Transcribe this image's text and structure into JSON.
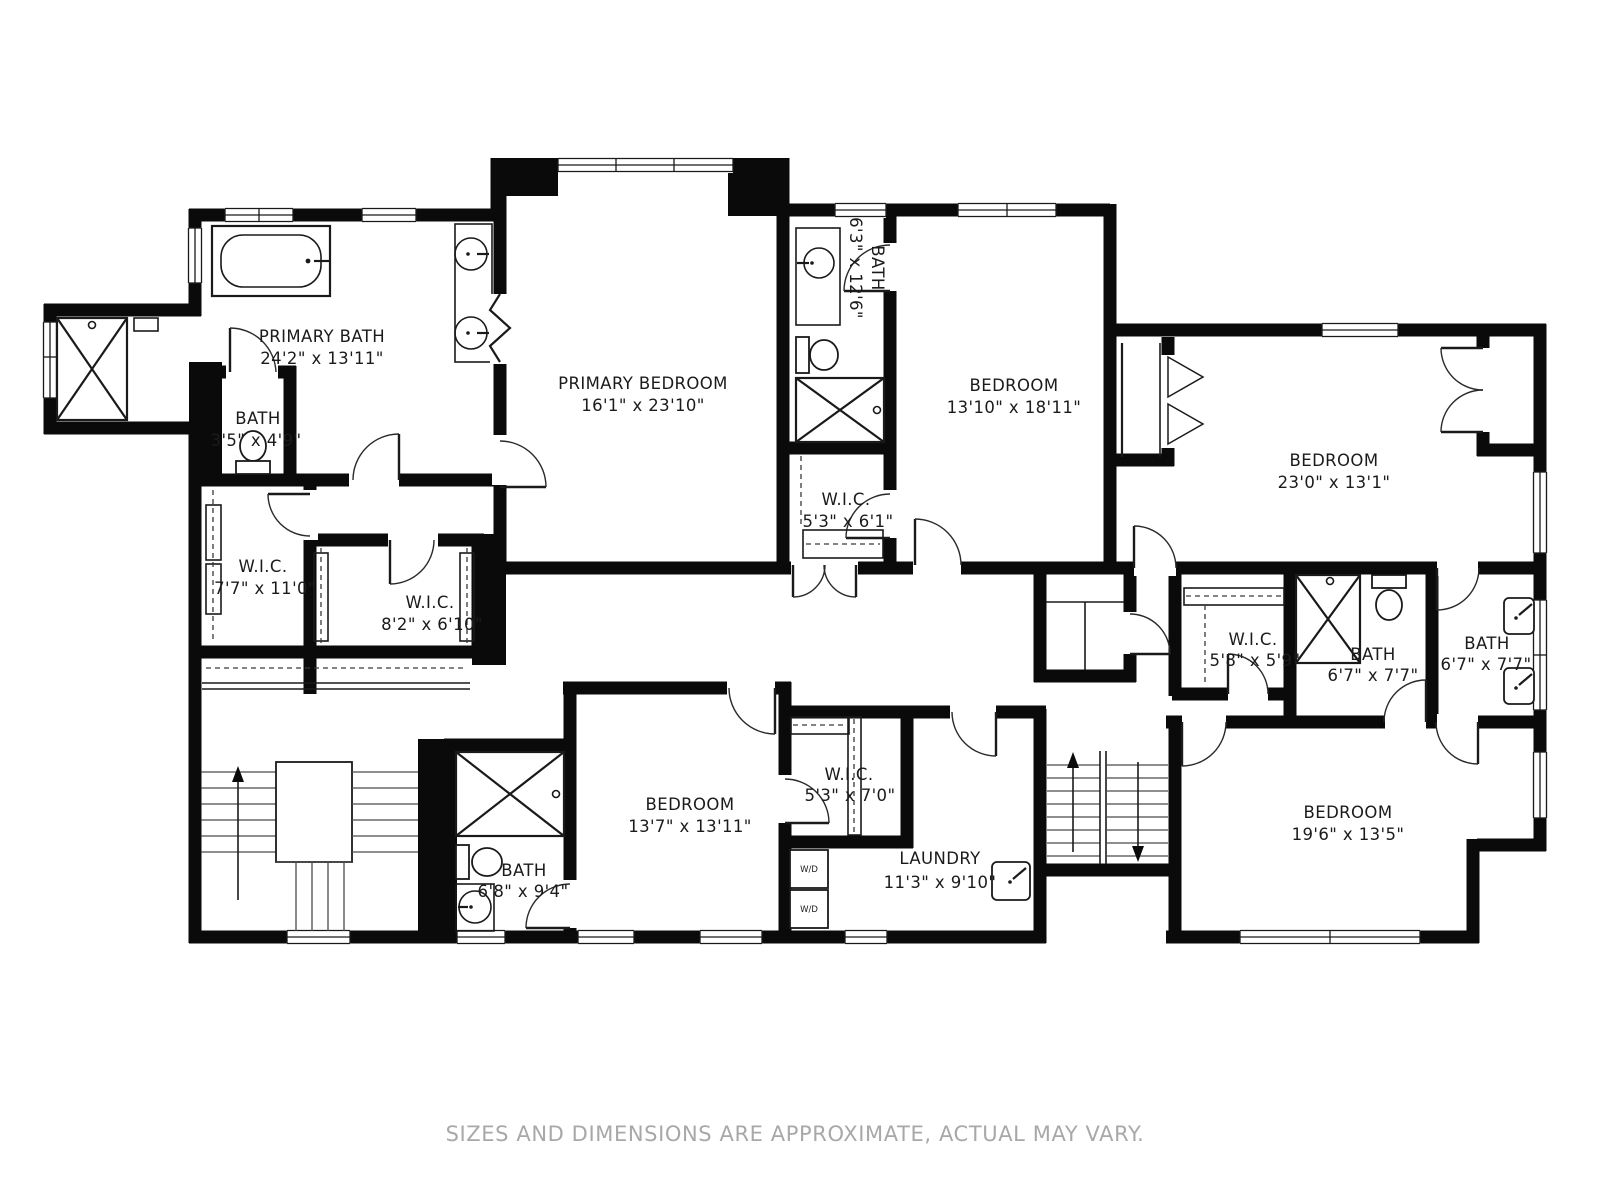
{
  "floorplan": {
    "rooms": [
      {
        "id": "primary-bath",
        "name": "PRIMARY BATH",
        "dims": "24'2\" x 13'11\""
      },
      {
        "id": "bath-small",
        "name": "BATH",
        "dims": "3'5\" x 4'9\""
      },
      {
        "id": "primary-bedroom",
        "name": "PRIMARY BEDROOM",
        "dims": "16'1\" x 23'10\""
      },
      {
        "id": "bath-ensuite",
        "name": "BATH",
        "dims": "6'3\" x 12'6\""
      },
      {
        "id": "bedroom-top",
        "name": "BEDROOM",
        "dims": "13'10\" x 18'11\""
      },
      {
        "id": "bedroom-right",
        "name": "BEDROOM",
        "dims": "23'0\" x 13'1\""
      },
      {
        "id": "wic-small",
        "name": "W.I.C.",
        "dims": "5'3\" x 6'1\""
      },
      {
        "id": "wic-left",
        "name": "W.I.C.",
        "dims": "7'7\" x 11'0\""
      },
      {
        "id": "wic-mid",
        "name": "W.I.C.",
        "dims": "8'2\" x 6'10\""
      },
      {
        "id": "wic-right",
        "name": "W.I.C.",
        "dims": "5'8\" x 5'9\""
      },
      {
        "id": "bath-shared-left",
        "name": "BATH",
        "dims": "6'7\" x 7'7\""
      },
      {
        "id": "bath-shared-right",
        "name": "BATH",
        "dims": "6'7\" x 7'7\""
      },
      {
        "id": "bedroom-bottom",
        "name": "BEDROOM",
        "dims": "13'7\" x 13'11\""
      },
      {
        "id": "wic-bottom",
        "name": "W.I.C.",
        "dims": "5'3\" x 7'0\""
      },
      {
        "id": "laundry",
        "name": "LAUNDRY",
        "dims": "11'3\" x 9'10\""
      },
      {
        "id": "bath-bottom",
        "name": "BATH",
        "dims": "6'8\" x 9'4\""
      },
      {
        "id": "bedroom-bottom-right",
        "name": "BEDROOM",
        "dims": "19'6\" x 13'5\""
      }
    ],
    "appliances": {
      "washer_dryer_top": "W/D",
      "washer_dryer_bottom": "W/D"
    },
    "footer": {
      "disclaimer": "SIZES AND DIMENSIONS ARE APPROXIMATE, ACTUAL MAY VARY."
    },
    "colors": {
      "wall": "#0a0a0a",
      "background": "#ffffff",
      "label": "#1b1b1b",
      "disclaimer": "#a8a8a8"
    }
  }
}
